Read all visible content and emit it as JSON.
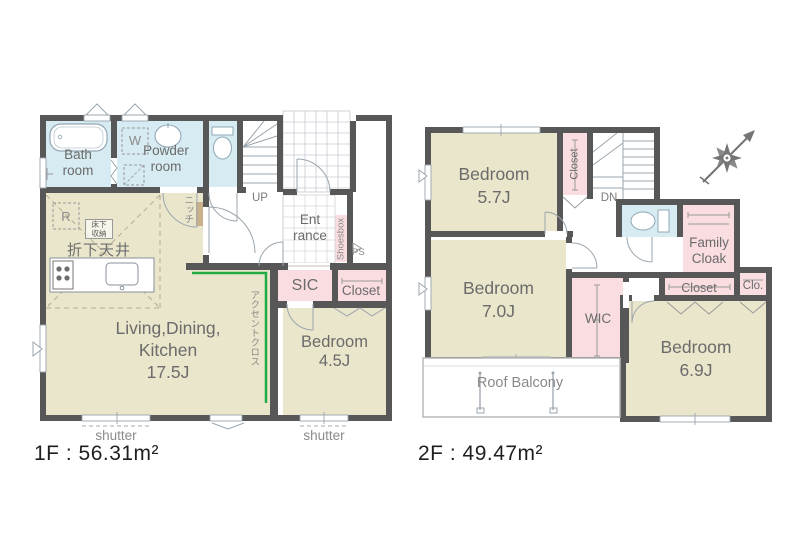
{
  "title": "Floor plan 1F / 2F",
  "colors": {
    "wall": "#575757",
    "room_beige": "#EAE6CB",
    "room_blue": "#D6EBF2",
    "room_pink": "#FADDE0",
    "accent_green": "#21AB44",
    "niche_tan": "#C9B28B",
    "line_gray": "#9AA5AD"
  },
  "floor1": {
    "area_label": "1F : 56.31m²",
    "rooms": {
      "bath": {
        "lines": [
          "Bath",
          "room"
        ]
      },
      "powder": {
        "lines": [
          "Powder",
          "room"
        ]
      },
      "washer_symbol": "W",
      "stairs_label": "UP",
      "entrance": {
        "lines": [
          "Ent",
          "rance"
        ]
      },
      "shoesbox": "Shoesbox",
      "pipe_space": "PS",
      "sic": "SIC",
      "closet": "Closet",
      "bedroom": {
        "lines": [
          "Bedroom",
          "4.5J"
        ]
      },
      "ldk": {
        "lines": [
          "Living,Dining,",
          "Kitchen",
          "17.5J"
        ]
      },
      "refrigerator_symbol": "R",
      "underfloor_storage": {
        "lines": [
          "床下",
          "収納"
        ]
      },
      "dropped_ceiling": "折下天井",
      "niche": "ニッチ",
      "accent_wallpaper": "アクセントクロス",
      "shutter_left": "shutter",
      "shutter_right": "shutter"
    }
  },
  "floor2": {
    "area_label": "2F : 49.47m²",
    "rooms": {
      "bedroom_57": {
        "lines": [
          "Bedroom",
          "5.7J"
        ]
      },
      "hall_closet": "Closet",
      "stairs_label": "DN",
      "bedroom_70": {
        "lines": [
          "Bedroom",
          "7.0J"
        ]
      },
      "wic": "WIC",
      "family_cloak": {
        "lines": [
          "Family",
          "Cloak"
        ]
      },
      "closet": "Closet",
      "closet_small": "Clo.",
      "bedroom_69": {
        "lines": [
          "Bedroom",
          "6.9J"
        ]
      },
      "roof_balcony": "Roof Balcony"
    }
  }
}
